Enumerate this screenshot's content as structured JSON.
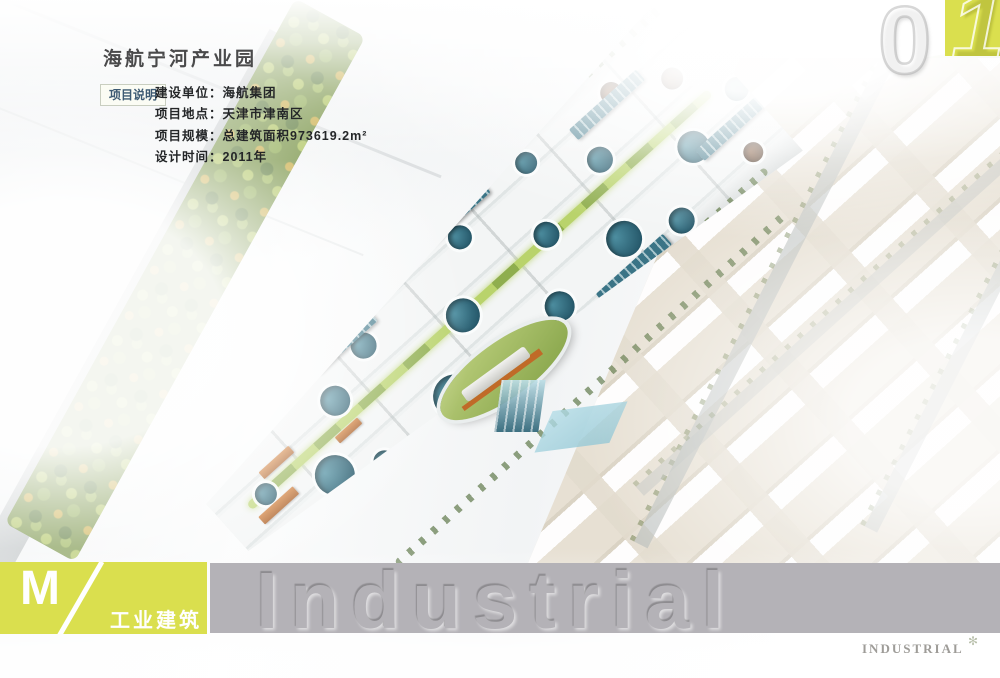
{
  "page_number": {
    "zero": "0",
    "one": "1"
  },
  "header": {
    "title": "海航宁河产业园",
    "info_label": "项目说明",
    "info_lines": [
      "建设单位：海航集团",
      "项目地点：天津市津南区",
      "项目规模：总建筑面积973619.2m²",
      "设计时间：2011年"
    ]
  },
  "footer": {
    "index_letter": "M",
    "category_cn": "工业建筑",
    "watermark_text": "Industrial",
    "category_en": "INDUSTRIAL"
  },
  "colors": {
    "accent_chartreuse": "#dadf4e",
    "band_gray": "#b4b2b7",
    "title_gray": "#4a4a4b",
    "teal_building": "#2e6578",
    "roof_orange": "#c06a28",
    "vegetation_green": "#6f8c3a"
  }
}
